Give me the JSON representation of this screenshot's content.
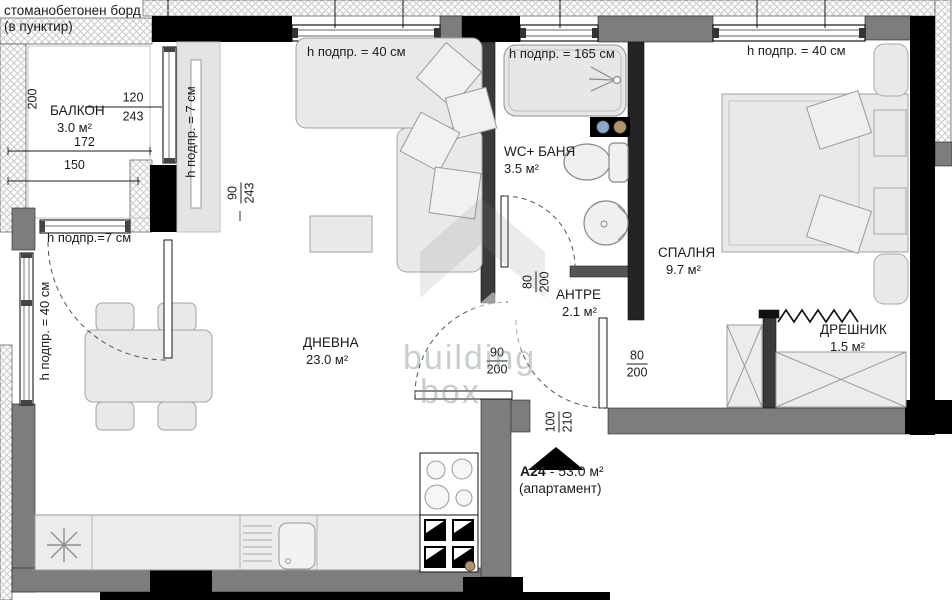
{
  "note": {
    "line1": "стоманобетонен борд",
    "line2": "(в пунктир)"
  },
  "rooms": {
    "balcony": {
      "name": "БАЛКОН",
      "area": "3.0 м²"
    },
    "living": {
      "name": "ДНЕВНА",
      "area": "23.0 м²"
    },
    "bath": {
      "name": "WC+ БАНЯ",
      "area": "3.5 м²"
    },
    "bedroom": {
      "name": "СПАЛНЯ",
      "area": "9.7 м²"
    },
    "hall": {
      "name": "АНТРЕ",
      "area": "2.1 м²"
    },
    "closet": {
      "name": "ДРЕШНИК",
      "area": "1.5 м²"
    }
  },
  "sills": {
    "h40": "h подпр. = 40 см",
    "h165": "h подпр. = 165 см",
    "h7v": "h подпр. = 7 см",
    "h7h": "h подпр.=7 см"
  },
  "dims": {
    "balcony_depth": "200",
    "balcony_len": "172",
    "balcony_len2": "150",
    "balcony_door_w": "120",
    "balcony_door_h": "243",
    "balcony_win_w": "90",
    "balcony_win_h": "243",
    "bath_door_w": "80",
    "bath_door_h": "200",
    "living_door_w": "90",
    "living_door_h": "200",
    "bedroom_door_w": "80",
    "bedroom_door_h": "200",
    "entry_door_w": "100",
    "entry_door_h": "210"
  },
  "apartment": {
    "id": "A24",
    "info": "- 53.0 м²",
    "type": "(апартамент)"
  },
  "watermark": {
    "line1": "building",
    "line2": "box"
  },
  "colors": {
    "wall_black": "#000000",
    "wall_gray": "#7d7d7d",
    "fixture_blue": "#8aa8cc",
    "fixture_tan": "#b0946a"
  }
}
